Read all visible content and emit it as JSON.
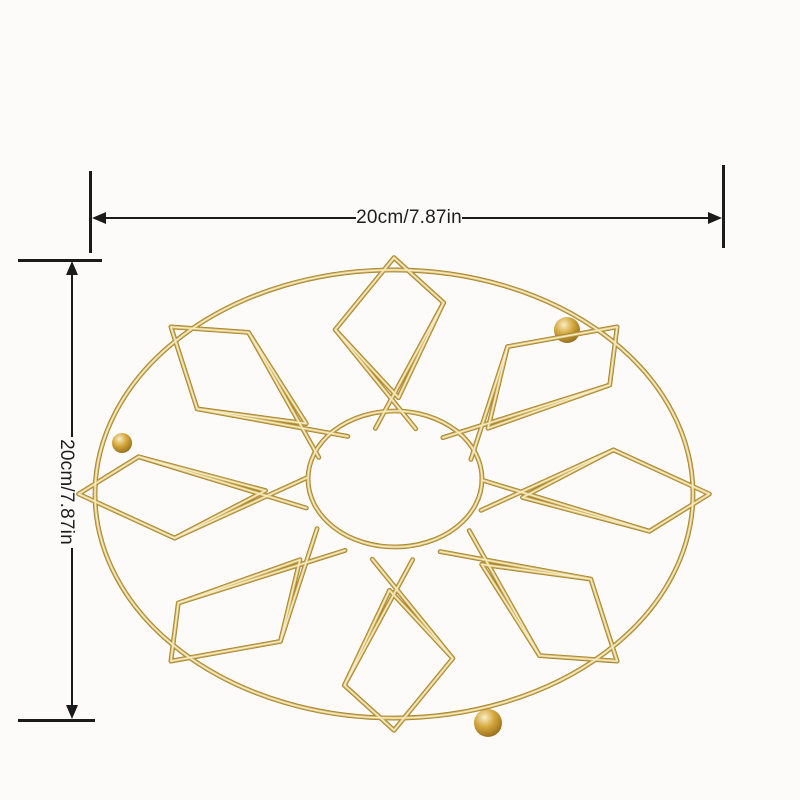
{
  "page": {
    "background": "#fcfbf9",
    "description": "Product dimension image: round gold metal wire trivet with geometric flower pattern and size annotations"
  },
  "dimension_annotations": {
    "line_color": "#1b1b1b",
    "text_color": "#1d1d1d",
    "width": {
      "label": "20cm/7.87in",
      "cm": "20cm",
      "inches": "7.87in"
    },
    "height": {
      "label": "20cm/7.87in",
      "cm": "20cm",
      "inches": "7.87in"
    }
  },
  "product": {
    "name": "round gold wire trivet",
    "petal_count": 8,
    "feet_count": 3,
    "colors": {
      "wire_base": "#a8862f",
      "wire_mid": "#d7ba6b",
      "wire_highlight": "#f6edc9",
      "ball_light": "#f8eec5",
      "ball_mid": "#d4a63b",
      "ball_dark": "#8a6517"
    }
  }
}
